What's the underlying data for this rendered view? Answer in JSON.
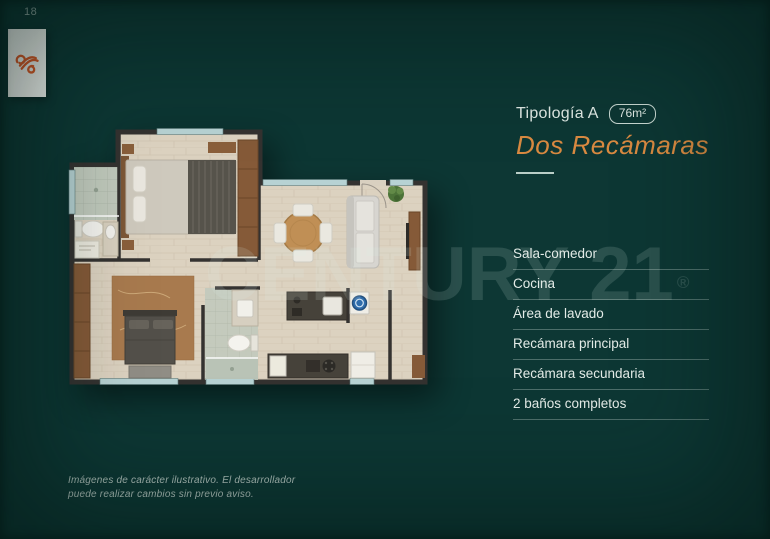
{
  "page": {
    "number": "18"
  },
  "brand": {
    "logo": "developer-logo",
    "logo_color": "#dd5a26",
    "card_color": "#f2f5f1"
  },
  "watermark": {
    "text": "CENTURY 21",
    "registered": "®"
  },
  "header": {
    "typology": "Tipología A",
    "area": "76m²",
    "subtitle": "Dos Recámaras"
  },
  "features": [
    "Sala-comedor",
    "Cocina",
    "Área de lavado",
    "Recámara principal",
    "Recámara secundaria",
    "2 baños completos"
  ],
  "disclaimer": {
    "line1": "Imágenes de carácter ilustrativo. El desarrollador",
    "line2": "puede realizar cambios sin previo aviso."
  },
  "colors": {
    "background": "#0d3734",
    "accent_orange": "#d98a41",
    "text_light": "#e3ebe7",
    "separator": "rgba(225,238,233,0.3)",
    "walls": "#343230",
    "floor": "#dcd2c0"
  }
}
